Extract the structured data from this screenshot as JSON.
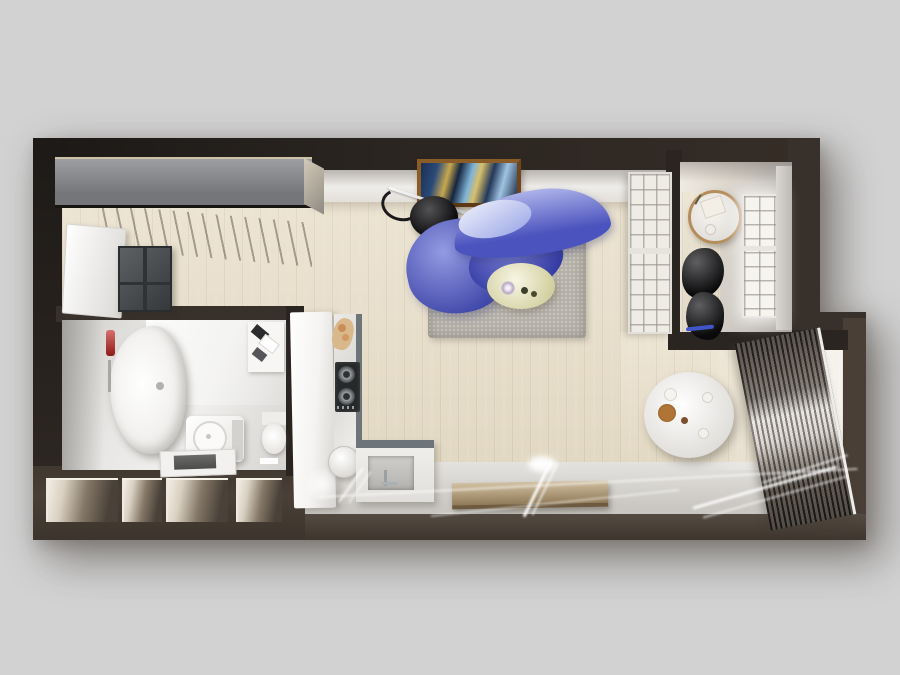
{
  "scene": {
    "type": "3d-floorplan-top-view",
    "rooms": [
      {
        "id": "closet-room",
        "name": "wardrobe closet room",
        "furniture": [
          "gray sliding-door wardrobe",
          "hanging rail with hangers",
          "white entry door",
          "dark drawer dresser"
        ]
      },
      {
        "id": "bathroom",
        "name": "bathroom",
        "furniture": [
          "freeform bathtub",
          "red wall dispenser",
          "towel shelf",
          "washing machine",
          "shower tray",
          "toilet"
        ]
      },
      {
        "id": "kitchen",
        "name": "kitchen",
        "furniture": [
          "tall white cabinet",
          "L-shaped marble counter",
          "gas hob",
          "cutting board",
          "round vessel bowl",
          "sink with faucet"
        ]
      },
      {
        "id": "living-room",
        "name": "living room",
        "furniture": [
          "abstract framed painting",
          "arc floor lamp",
          "blue curved sofa",
          "gray area rug",
          "oval coffee table",
          "wood media console"
        ]
      },
      {
        "id": "dining-nook",
        "name": "dining nook",
        "furniture": [
          "round marble dining table",
          "four gray upholstered chairs",
          "floor-to-ceiling window with drapes"
        ]
      },
      {
        "id": "study-room",
        "name": "small side room",
        "furniture": [
          "round side table",
          "black sculptural chair",
          "glazed window",
          "french glass door"
        ]
      },
      {
        "id": "walkway",
        "name": "entry walkway",
        "furniture": [
          "storage cubbies",
          "light streaks from windows"
        ]
      }
    ]
  },
  "palette": {
    "canvas": "#d2d2d2",
    "wall_dark": "#2a2521",
    "wall_mid": "#38302b",
    "wall_brown": "#493f36",
    "floor_wood": "#e9dfc9",
    "walkway_gray": "#d6d3ce",
    "sofa_blue": "#5a64d2",
    "sofa_blue_deep": "#434cc2",
    "pillow_blue": "#c0c9f2",
    "rug_gray": "#b5b1a9",
    "coffee_table_cream": "#e7e5b4",
    "wardrobe_gray": "#84868a",
    "dresser_gray": "#43474a",
    "door_white": "#f7f6f4",
    "dining_table_white": "#efedea",
    "chair_gray": "#8d8d8b",
    "curtain_dark": "#39322b",
    "curtain_sheer": "#ddd8d0",
    "console_wood": "#bda479",
    "marble_white": "#f1f0ee",
    "counter_edge_gray": "#6d757b",
    "hob_black": "#26282a",
    "art_frame_wood": "#7d5124",
    "accent_red": "#c0231f",
    "accent_blue_edge": "#4056c8",
    "lamp_black": "#222226",
    "table_ring_bronze": "#b58d5c",
    "tub_white": "#f6f5f3"
  }
}
